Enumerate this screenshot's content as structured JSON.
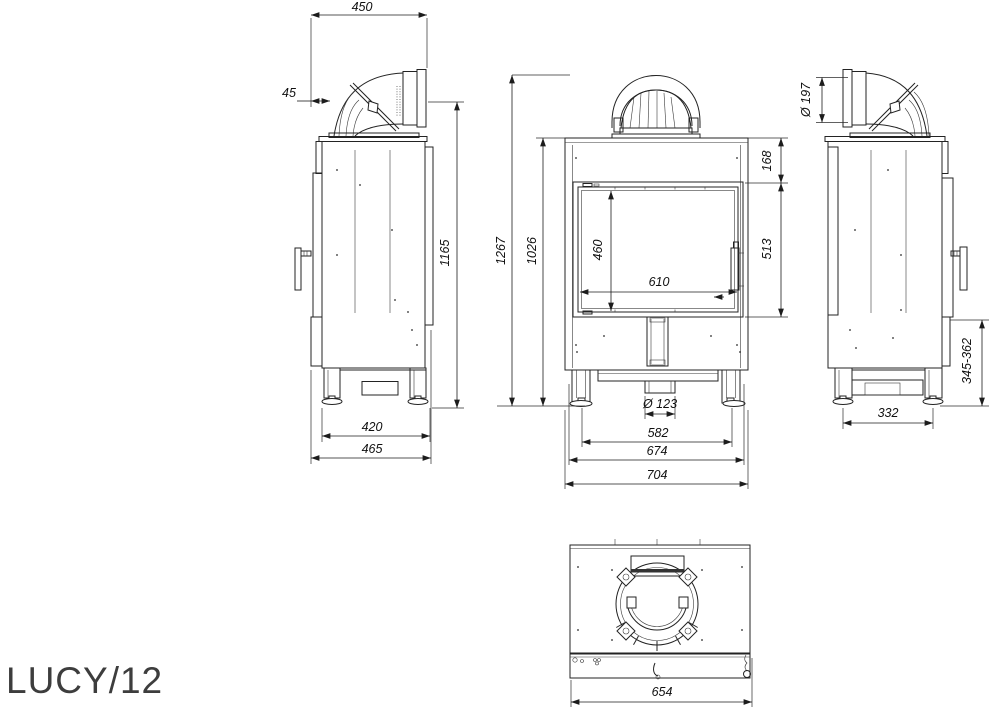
{
  "title": "LUCY/12",
  "views": {
    "side_left": {
      "label": "left side view",
      "dims": {
        "depth_with_flue": "450",
        "flue_offset": "45",
        "height_body": "1165",
        "feet_span": "420",
        "depth_total": "465"
      }
    },
    "front": {
      "label": "front view",
      "dims": {
        "height_total": "1267",
        "height_body": "1026",
        "top_band": "168",
        "door_height": "513",
        "glass_height": "460",
        "glass_width": "610",
        "air_inlet_dia": "Ø 123",
        "feet_span": "582",
        "body_width": "674",
        "width_total": "704"
      }
    },
    "side_right": {
      "label": "right side view",
      "dims": {
        "flue_dia": "Ø 197",
        "base_height_range": "345-362",
        "feet_span": "332"
      }
    },
    "top": {
      "label": "top view",
      "dims": {
        "depth": "654"
      }
    }
  }
}
